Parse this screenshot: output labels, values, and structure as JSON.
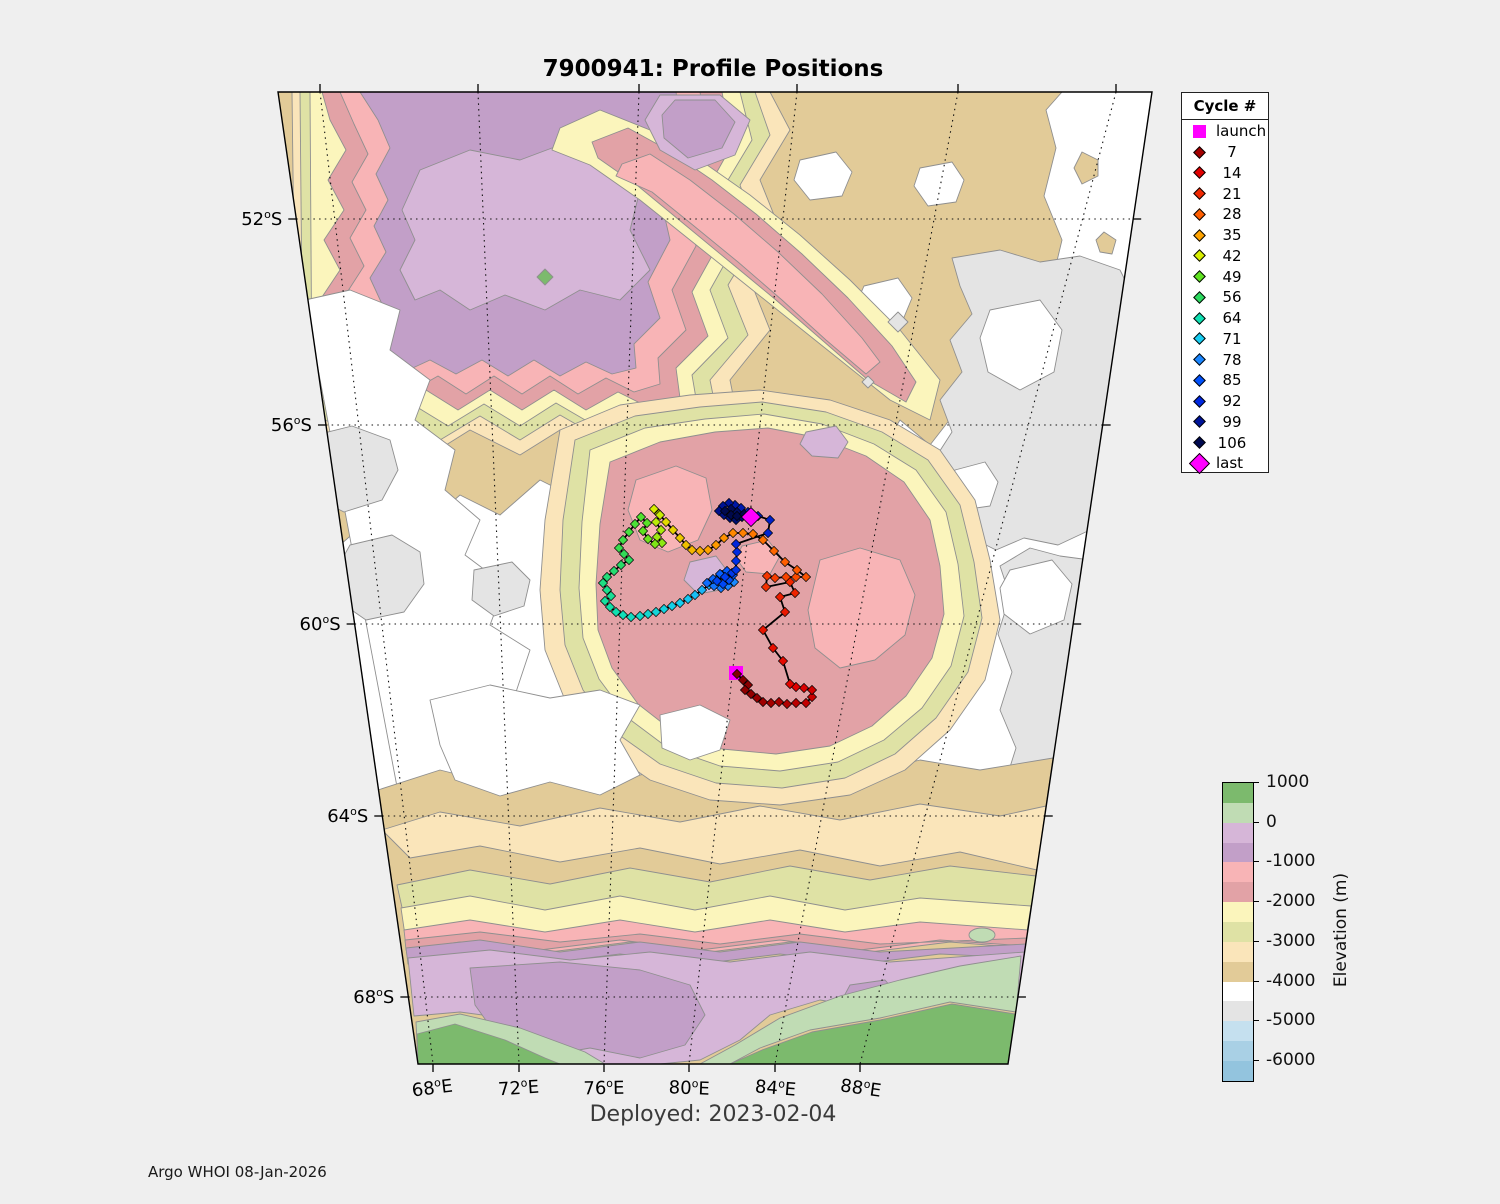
{
  "title": "7900941: Profile Positions",
  "deployed_label": "Deployed: 2023-02-04",
  "credit": "Argo WHOI 08-Jan-2026",
  "legend": {
    "header": "Cycle #",
    "entries": [
      {
        "label": "launch",
        "marker": "square",
        "color": "#ff00ff"
      },
      {
        "label": "7",
        "marker": "diamond",
        "color": "#a30000"
      },
      {
        "label": "14",
        "marker": "diamond",
        "color": "#e00000"
      },
      {
        "label": "21",
        "marker": "diamond",
        "color": "#f02800"
      },
      {
        "label": "28",
        "marker": "diamond",
        "color": "#ff5e00"
      },
      {
        "label": "35",
        "marker": "diamond",
        "color": "#ffa300"
      },
      {
        "label": "42",
        "marker": "diamond",
        "color": "#d8ee00"
      },
      {
        "label": "49",
        "marker": "diamond",
        "color": "#5fe320"
      },
      {
        "label": "56",
        "marker": "diamond",
        "color": "#2cda5f"
      },
      {
        "label": "64",
        "marker": "diamond",
        "color": "#0fe0b2"
      },
      {
        "label": "71",
        "marker": "diamond",
        "color": "#17cdf1"
      },
      {
        "label": "78",
        "marker": "diamond",
        "color": "#1b86ff"
      },
      {
        "label": "85",
        "marker": "diamond",
        "color": "#0050fa"
      },
      {
        "label": "92",
        "marker": "diamond",
        "color": "#0028e0"
      },
      {
        "label": "99",
        "marker": "diamond",
        "color": "#001499"
      },
      {
        "label": "106",
        "marker": "diamond",
        "color": "#000a50"
      },
      {
        "label": "last",
        "marker": "diamond-large",
        "color": "#ff00ff"
      }
    ]
  },
  "colorbar": {
    "title": "Elevation (m)",
    "tick_labels": [
      "1000",
      "0",
      "-1000",
      "-2000",
      "-3000",
      "-4000",
      "-5000",
      "-6000"
    ],
    "segment_keys": [
      "green1000",
      "green500",
      "purple0",
      "purpleM500",
      "pinkM1000",
      "pinkM1500",
      "yellowM2000",
      "oliveM2500",
      "tanM3000",
      "tanM3500",
      "whiteM4000",
      "grayM4500",
      "blueM5000",
      "blueM5500",
      "blueM6000"
    ]
  },
  "palette": {
    "green1000": "#7cba6d",
    "green500": "#c0dcb4",
    "purple0": "#d6b6d8",
    "purpleM500": "#c29fc8",
    "pinkM1000": "#f8b4b6",
    "pinkM1500": "#e2a2a6",
    "yellowM2000": "#fbf5bc",
    "oliveM2500": "#dfe2a5",
    "tanM3000": "#fae5ba",
    "tanM3500": "#e2cb98",
    "whiteM4000": "#ffffff",
    "grayM4500": "#e4e4e4",
    "blueM5000": "#c5e0ef",
    "blueM5500": "#a9d0e5",
    "blueM6000": "#93c4de"
  },
  "axes": {
    "lat_hemisphere": "S",
    "lon_hemisphere": "E",
    "lat_ticks": [
      {
        "deg": "52",
        "y": 219
      },
      {
        "deg": "56",
        "y": 425
      },
      {
        "deg": "60",
        "y": 624
      },
      {
        "deg": "64",
        "y": 816
      },
      {
        "deg": "68",
        "y": 997
      }
    ],
    "lon_ticks": [
      {
        "deg": "68",
        "x_top": 320,
        "x_bottom": 433,
        "rot": -7
      },
      {
        "deg": "72",
        "x_top": 478,
        "x_bottom": 519,
        "rot": -4
      },
      {
        "deg": "76",
        "x_top": 639,
        "x_bottom": 604,
        "rot": -1
      },
      {
        "deg": "80",
        "x_top": 797,
        "x_bottom": 689,
        "rot": 2
      },
      {
        "deg": "84",
        "x_top": 958,
        "x_bottom": 775,
        "rot": 5
      },
      {
        "deg": "88",
        "x_top": 1116,
        "x_bottom": 860,
        "rot": 8
      }
    ],
    "frame": {
      "top_left_x": 278,
      "top_right_x": 1152,
      "bottom_left_x": 418,
      "bottom_right_x": 1008,
      "top_y": 92,
      "bottom_y": 1064
    }
  },
  "track": {
    "launch": {
      "x": 736,
      "y": 673
    },
    "last": {
      "x": 751,
      "y": 517
    },
    "marker_color_launch_last": "#ff00ff",
    "max_cycle": 110,
    "color_stops": [
      [
        0,
        "#7a0000"
      ],
      [
        7,
        "#a30000"
      ],
      [
        14,
        "#e00000"
      ],
      [
        21,
        "#f02800"
      ],
      [
        28,
        "#ff5e00"
      ],
      [
        35,
        "#ffa300"
      ],
      [
        42,
        "#d8ee00"
      ],
      [
        49,
        "#5fe320"
      ],
      [
        56,
        "#2cda5f"
      ],
      [
        64,
        "#0fe0b2"
      ],
      [
        71,
        "#17cdf1"
      ],
      [
        78,
        "#1b86ff"
      ],
      [
        85,
        "#0050fa"
      ],
      [
        92,
        "#0028e0"
      ],
      [
        99,
        "#001499"
      ],
      [
        106,
        "#000a50"
      ],
      [
        113,
        "#000640"
      ]
    ],
    "points": [
      [
        737,
        674
      ],
      [
        743,
        680
      ],
      [
        748,
        685
      ],
      [
        745,
        690
      ],
      [
        751,
        694
      ],
      [
        757,
        698
      ],
      [
        763,
        702
      ],
      [
        771,
        703
      ],
      [
        779,
        702
      ],
      [
        787,
        704
      ],
      [
        796,
        703
      ],
      [
        806,
        703
      ],
      [
        812,
        697
      ],
      [
        812,
        690
      ],
      [
        804,
        688
      ],
      [
        796,
        687
      ],
      [
        790,
        684
      ],
      [
        783,
        661
      ],
      [
        773,
        648
      ],
      [
        763,
        630
      ],
      [
        785,
        612
      ],
      [
        780,
        597
      ],
      [
        795,
        593
      ],
      [
        790,
        582
      ],
      [
        766,
        587
      ],
      [
        767,
        576
      ],
      [
        775,
        578
      ],
      [
        786,
        577
      ],
      [
        796,
        577
      ],
      [
        806,
        577
      ],
      [
        797,
        570
      ],
      [
        785,
        562
      ],
      [
        774,
        551
      ],
      [
        763,
        540
      ],
      [
        753,
        534
      ],
      [
        743,
        533
      ],
      [
        733,
        533
      ],
      [
        724,
        538
      ],
      [
        716,
        545
      ],
      [
        708,
        550
      ],
      [
        700,
        551
      ],
      [
        692,
        550
      ],
      [
        686,
        545
      ],
      [
        680,
        538
      ],
      [
        673,
        530
      ],
      [
        666,
        522
      ],
      [
        659,
        514
      ],
      [
        654,
        509
      ],
      [
        660,
        515
      ],
      [
        656,
        522
      ],
      [
        661,
        530
      ],
      [
        657,
        537
      ],
      [
        662,
        543
      ],
      [
        655,
        544
      ],
      [
        648,
        539
      ],
      [
        643,
        531
      ],
      [
        647,
        523
      ],
      [
        641,
        517
      ],
      [
        635,
        524
      ],
      [
        629,
        532
      ],
      [
        623,
        540
      ],
      [
        619,
        548
      ],
      [
        624,
        554
      ],
      [
        629,
        560
      ],
      [
        621,
        565
      ],
      [
        614,
        571
      ],
      [
        607,
        577
      ],
      [
        603,
        583
      ],
      [
        607,
        590
      ],
      [
        611,
        596
      ],
      [
        605,
        601
      ],
      [
        610,
        607
      ],
      [
        616,
        612
      ],
      [
        623,
        615
      ],
      [
        631,
        617
      ],
      [
        640,
        616
      ],
      [
        648,
        614
      ],
      [
        656,
        612
      ],
      [
        664,
        609
      ],
      [
        672,
        606
      ],
      [
        680,
        603
      ],
      [
        688,
        599
      ],
      [
        695,
        595
      ],
      [
        702,
        590
      ],
      [
        709,
        585
      ],
      [
        716,
        580
      ],
      [
        722,
        575
      ],
      [
        728,
        578
      ],
      [
        734,
        582
      ],
      [
        728,
        586
      ],
      [
        721,
        588
      ],
      [
        714,
        586
      ],
      [
        707,
        583
      ],
      [
        713,
        579
      ],
      [
        720,
        574
      ],
      [
        727,
        571
      ],
      [
        733,
        575
      ],
      [
        729,
        580
      ],
      [
        723,
        584
      ],
      [
        717,
        581
      ],
      [
        725,
        577
      ],
      [
        732,
        573
      ],
      [
        736,
        570
      ],
      [
        736,
        561
      ],
      [
        737,
        552
      ],
      [
        736,
        544
      ],
      [
        768,
        533
      ],
      [
        770,
        520
      ],
      [
        758,
        516
      ],
      [
        748,
        512
      ],
      [
        741,
        508
      ],
      [
        735,
        505
      ],
      [
        729,
        503
      ],
      [
        723,
        506
      ],
      [
        719,
        511
      ],
      [
        724,
        515
      ],
      [
        730,
        518
      ],
      [
        736,
        520
      ],
      [
        742,
        517
      ],
      [
        737,
        512
      ],
      [
        731,
        509
      ],
      [
        725,
        511
      ],
      [
        731,
        515
      ],
      [
        737,
        516
      ],
      [
        744,
        514
      ],
      [
        748,
        516
      ]
    ]
  },
  "chart_data": {
    "type": "scatter",
    "title": "7900941: Profile Positions",
    "xlabel": "Longitude",
    "ylabel": "Latitude",
    "x_tick_labels": [
      "68°E",
      "72°E",
      "76°E",
      "80°E",
      "84°E",
      "88°E"
    ],
    "y_tick_labels": [
      "52°S",
      "56°S",
      "60°S",
      "64°S",
      "68°S"
    ],
    "projection": "polar fan projection, lon ~66-90E, lat ~49.5-69.5S",
    "float_id": "7900941",
    "deployment_date": "2023-02-04",
    "launch_position_deg": {
      "lon_e": 80.1,
      "lat_s": 61.0
    },
    "last_position_deg": {
      "lon_e": 80.0,
      "lat_s": 57.9
    },
    "legend_cycles": [
      7,
      14,
      21,
      28,
      35,
      42,
      49,
      56,
      64,
      71,
      78,
      85,
      92,
      99,
      106
    ],
    "elevation_colorbar_m": {
      "max": 1000,
      "min": -6500,
      "band_step": 500,
      "tick_values": [
        1000,
        0,
        -1000,
        -2000,
        -3000,
        -4000,
        -5000,
        -6000
      ]
    },
    "track_summary": "Float launched near 80.1E 61.0S; early cycles (dark red) loop SE to ~81E 61.3S, red cycles head N to ~80.5E 59.2S, orange cycles zigzag then move NW, yellow-green cycles loop W/SW near 75-76E 58-59S, cyan cycles run E along 59.9S, blue cycles cluster near 79E 59.5S, then NE jump to navy cluster ending at last position ~80E 57.9S (~110 cycles).",
    "note": "track pixel points map to lon/lat via axes.lat_ticks (y) and axes.lon_ticks (x interpolated between x_top at y=92 and x_bottom at y=1064)"
  }
}
